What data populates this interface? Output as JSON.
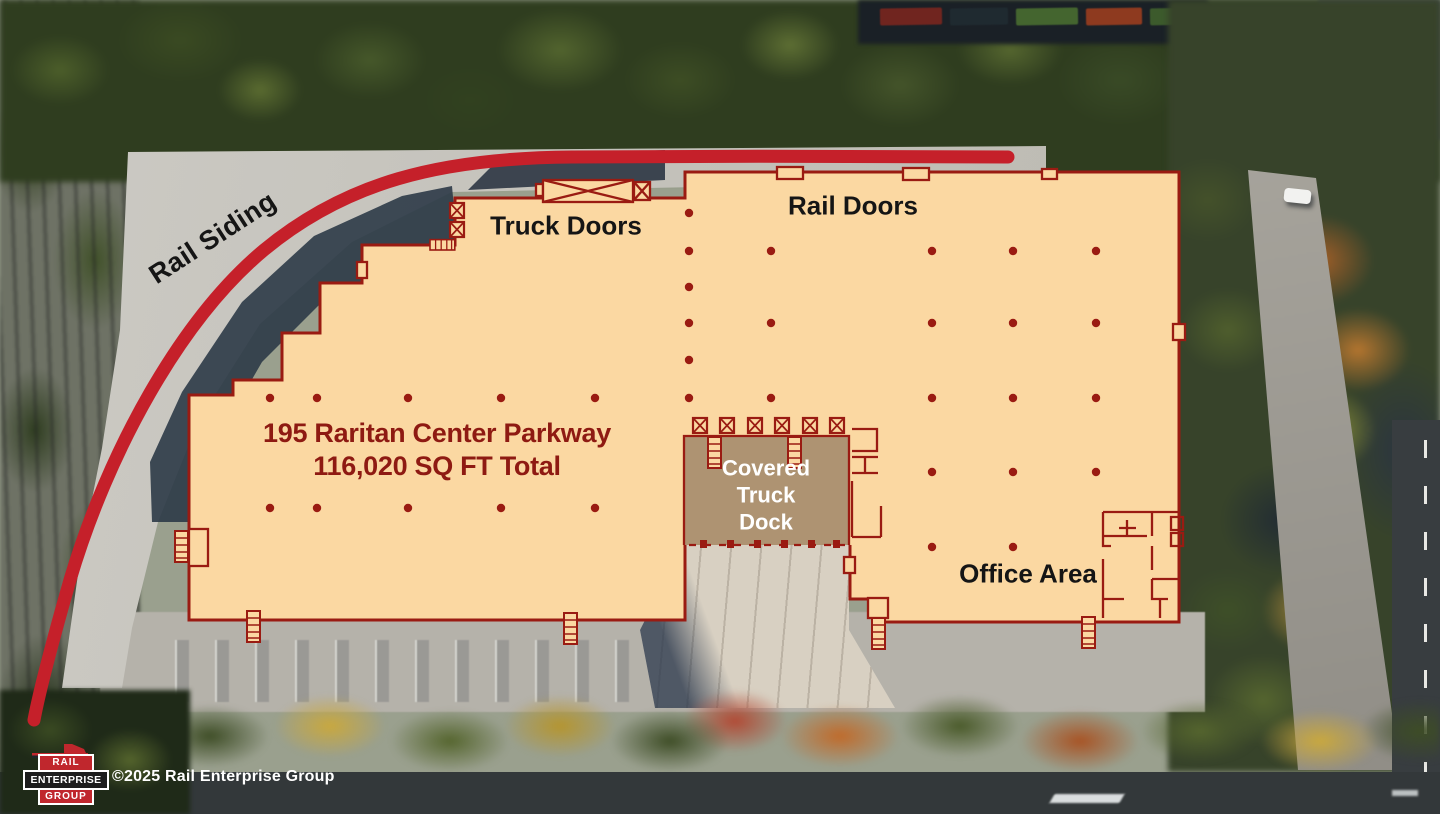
{
  "colors": {
    "building_fill": "#FBD8A2",
    "outline_maroon": "#9A1B12",
    "rail_line_red": "#C5202A",
    "dock_fill": "#AE9372",
    "text_black": "#151515",
    "text_maroon": "#8E1A12",
    "text_white": "#FFFFFF",
    "logo_red": "#C0272D",
    "logo_dark": "#1D1D1D"
  },
  "labels": {
    "rail_siding": "Rail Siding",
    "truck_doors": "Truck Doors",
    "rail_doors": "Rail Doors",
    "office_area": "Office Area",
    "dock_line1": "Covered",
    "dock_line2": "Truck",
    "dock_line3": "Dock",
    "address_line1": "195 Raritan Center Parkway",
    "address_line2": "116,020 SQ FT Total"
  },
  "footer": {
    "copyright": "©2025 Rail Enterprise Group",
    "logo": {
      "line1": "RAIL",
      "line2": "ENTERPRISE",
      "line3": "GROUP"
    }
  },
  "icons": {
    "dock_door": "square-with-x",
    "ladder": "striped-rect",
    "rail_door": "small-wall-rect",
    "column_dot": "filled-circle",
    "locomotive": "red-train-silhouette"
  },
  "building": {
    "column_dots": [
      [
        270,
        398
      ],
      [
        317,
        398
      ],
      [
        408,
        398
      ],
      [
        501,
        398
      ],
      [
        595,
        398
      ],
      [
        270,
        508
      ],
      [
        317,
        508
      ],
      [
        408,
        508
      ],
      [
        501,
        508
      ],
      [
        595,
        508
      ],
      [
        689,
        213
      ],
      [
        689,
        251
      ],
      [
        689,
        287
      ],
      [
        689,
        323
      ],
      [
        689,
        360
      ],
      [
        689,
        398
      ],
      [
        771,
        251
      ],
      [
        771,
        323
      ],
      [
        771,
        398
      ],
      [
        932,
        251
      ],
      [
        932,
        323
      ],
      [
        932,
        398
      ],
      [
        932,
        472
      ],
      [
        932,
        547
      ],
      [
        1013,
        251
      ],
      [
        1013,
        323
      ],
      [
        1013,
        398
      ],
      [
        1013,
        472
      ],
      [
        1013,
        547
      ],
      [
        1096,
        251
      ],
      [
        1096,
        323
      ],
      [
        1096,
        398
      ],
      [
        1096,
        472
      ]
    ]
  }
}
